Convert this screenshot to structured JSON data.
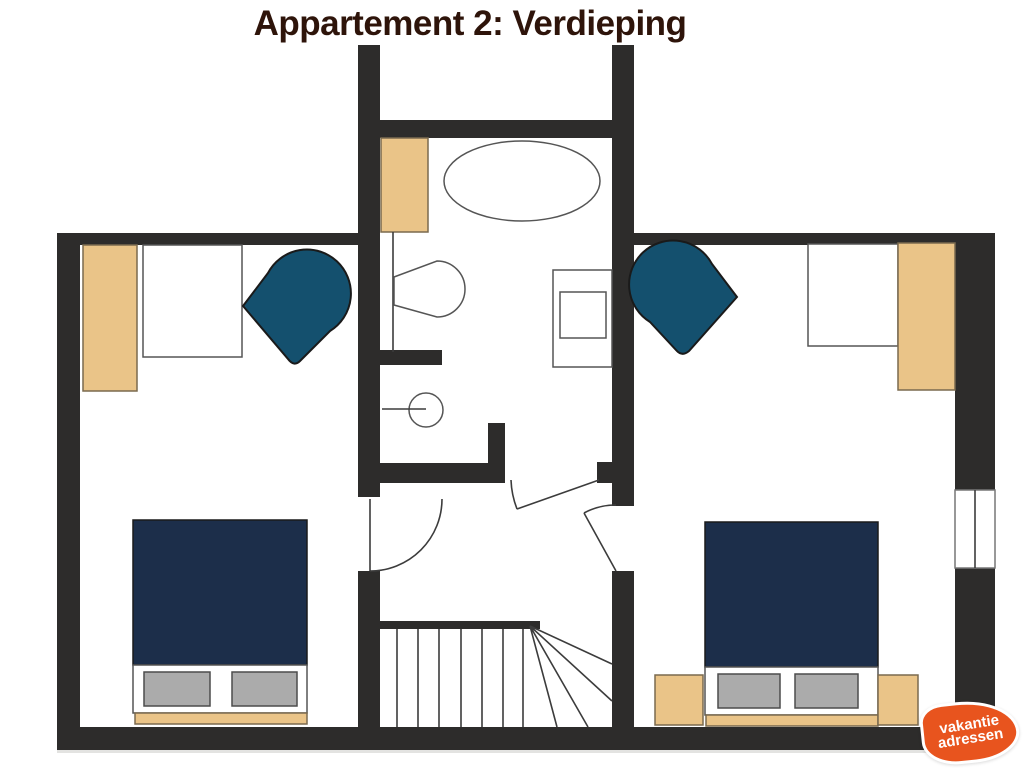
{
  "title": "Appartement 2: Verdieping",
  "logo": {
    "line1": "vakantie",
    "line2": "adressen"
  },
  "colors": {
    "background": "#ffffff",
    "wall": "#2d2c2b",
    "title": "#2e140a",
    "wood": "#eac488",
    "wood-border": "#7a6a4f",
    "bed": "#1c2e4a",
    "chair": "#14506e",
    "dark-outline": "#1a1a1a",
    "pillow": "#ababab",
    "pillow-border": "#4c4c4c",
    "line": "#3c3c3c",
    "fixture": "#555555",
    "logo-orange": "#e8541e",
    "logo-text": "#ffffff",
    "shadow": "#e3e3e1"
  },
  "floorplan": {
    "icons": [
      "wardrobe",
      "table",
      "armchair",
      "double-bed",
      "pillow",
      "nightstand",
      "bathroom-cabinet",
      "bathtub",
      "toilet",
      "vanity-basin",
      "washbasin",
      "window",
      "door-swing",
      "staircase"
    ]
  }
}
